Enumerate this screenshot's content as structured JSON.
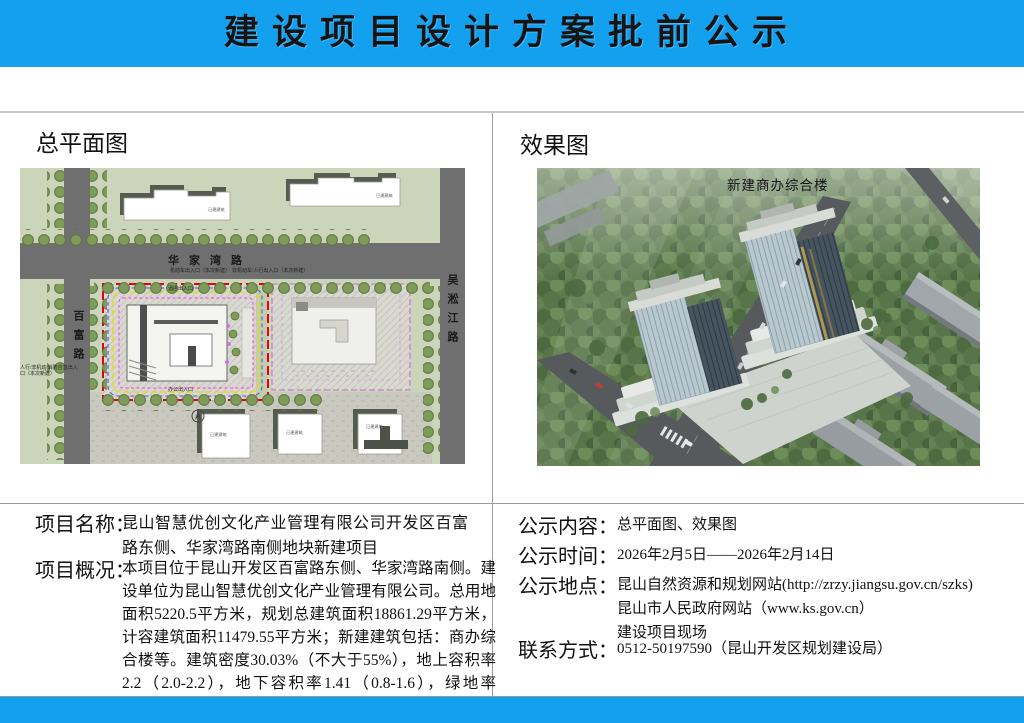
{
  "header": {
    "title": "建设项目设计方案批前公示"
  },
  "colors": {
    "banner_blue": "#12A0EF",
    "site_boundary_red": "#E60012",
    "parcel_purple": "#C97FD2",
    "plan_background_green": "#CCD4BA",
    "road_gray": "#6F6F6F"
  },
  "left_panel": {
    "title": "总平面图",
    "site_plan": {
      "road_top": "华家湾路",
      "road_left": "百富路",
      "road_right": "吴淞江路",
      "entrance_motor": "机动车出入口（本次新建）",
      "entrance_nonmotor": "非机动车/人行出入口（本次新建）",
      "entrance_west": "人行/非机动/消防应急出入口（本次新建）",
      "entrance_hotel": "酒店出入口",
      "entrance_office": "办公出入口",
      "existing_building": "已建建筑"
    }
  },
  "right_panel": {
    "title": "效果图",
    "rendering_label": "新建商办综合楼"
  },
  "project": {
    "name_label": "项目名称：",
    "name_value": "昆山智慧优创文化产业管理有限公司开发区百富路东侧、华家湾路南侧地块新建项目",
    "overview_label": "项目概况：",
    "overview_value": "本项目位于昆山开发区百富路东侧、华家湾路南侧。建设单位为昆山智慧优创文化产业管理有限公司。总用地面积5220.5平方米，规划总建筑面积18861.29平方米，计容建筑面积11479.55平方米；新建建筑包括：商办综合楼等。建筑密度30.03%（不大于55%），地上容积率2.2（2.0-2.2），地下容积率1.41（0.8-1.6），绿地率21.01%（不小于20%）。"
  },
  "notice": {
    "content_label": "公示内容：",
    "content_value": "总平面图、效果图",
    "time_label": "公示时间：",
    "time_value": "2026年2月5日——2026年2月14日",
    "place_label": "公示地点：",
    "place_line1": "昆山自然资源和规划网站(http://zrzy.jiangsu.gov.cn/szks)",
    "place_line2": "昆山市人民政府网站（www.ks.gov.cn）",
    "place_line3": "建设项目现场",
    "contact_label": "联系方式：",
    "contact_value": "0512-50197590（昆山开发区规划建设局）"
  }
}
